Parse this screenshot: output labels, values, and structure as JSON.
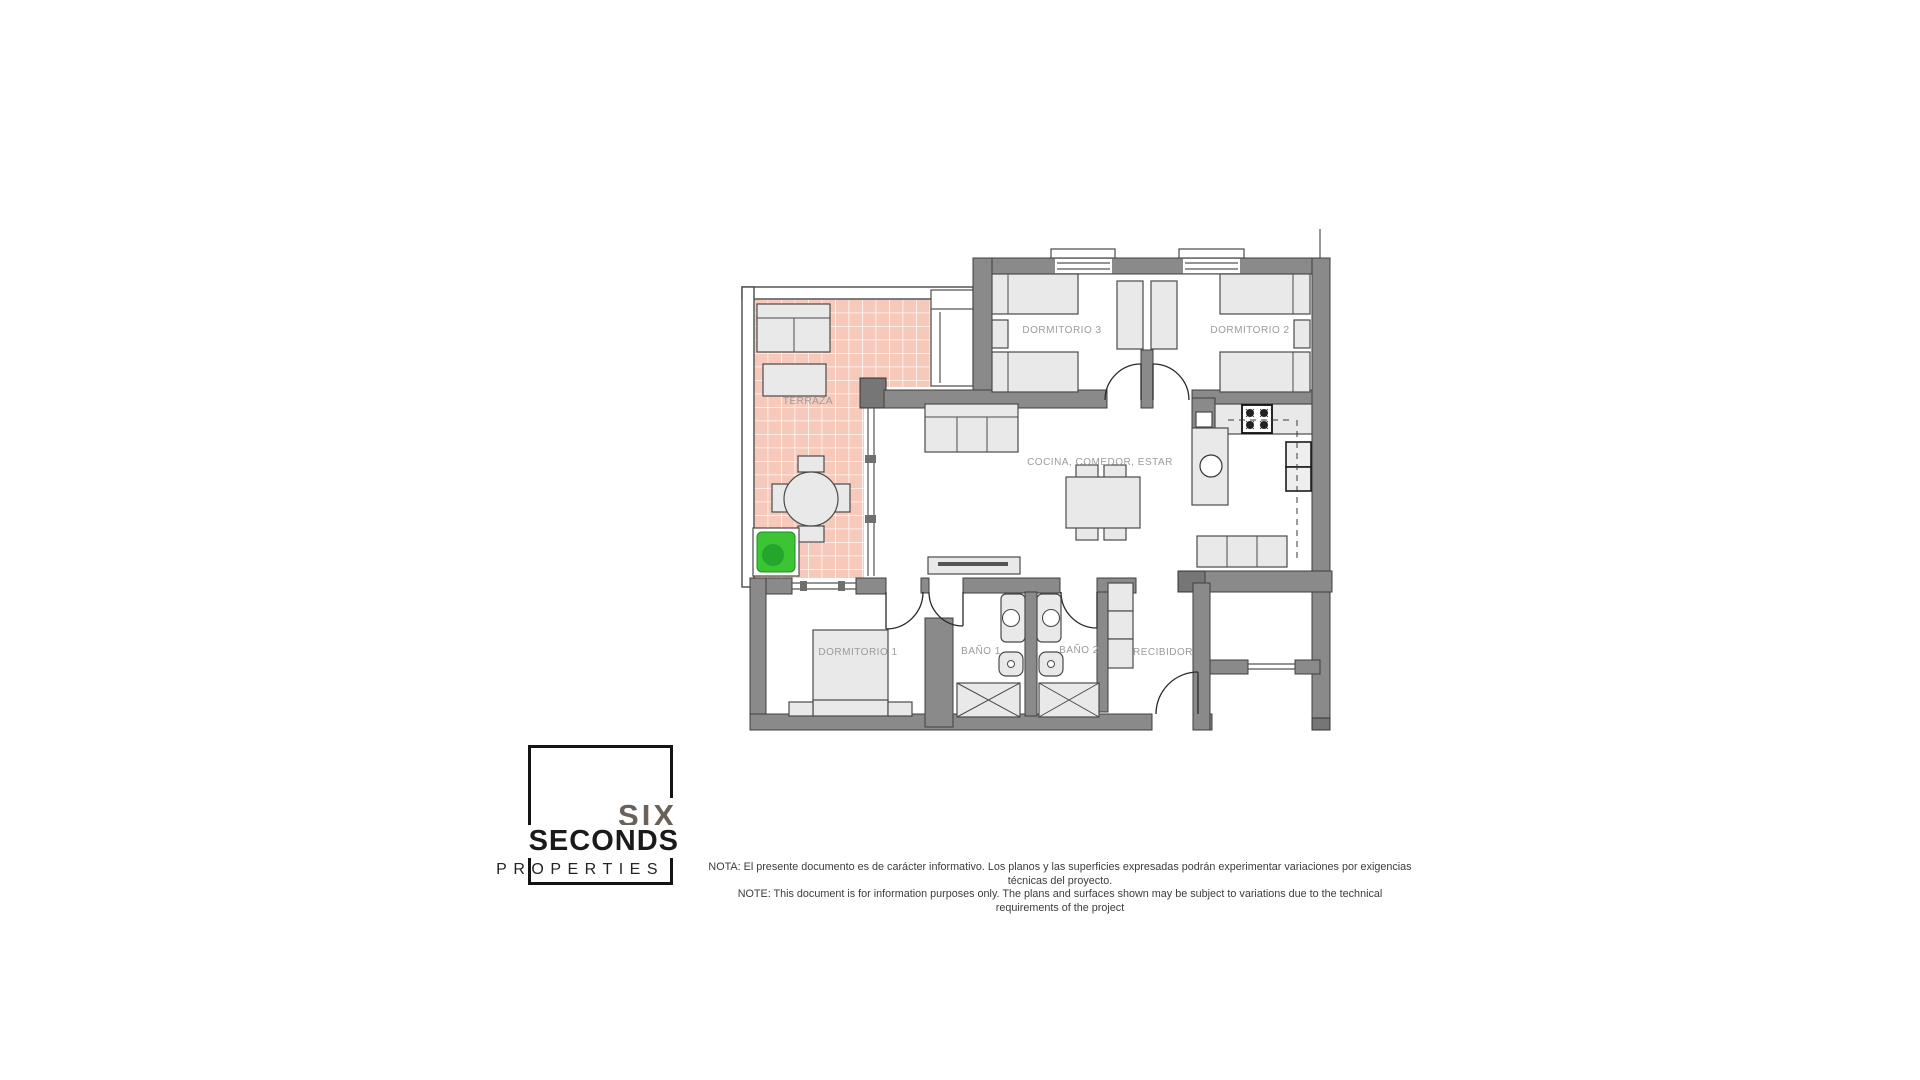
{
  "colors": {
    "background": "#ffffff",
    "wall-gray": "#8a8a8a",
    "wall-outline": "#3f3f3f",
    "furniture-fill": "#e9e9e9",
    "furniture-stroke": "#4a4a4a",
    "terrace-tile": "#f6c9bb",
    "tile-grout": "#ffffff",
    "plant-green": "#3cc435",
    "plant-green-dark": "#1e9e2a",
    "label-gray": "#9b9b9b",
    "logo-six-color": "#6a6158",
    "logo-black": "#1a1a1a",
    "text-dark": "#3c3c3c"
  },
  "plan": {
    "rooms": [
      {
        "id": "terraza",
        "label": "TERRAZA"
      },
      {
        "id": "dormitorio-3",
        "label": "DORMITORIO 3"
      },
      {
        "id": "dormitorio-2",
        "label": "DORMITORIO 2"
      },
      {
        "id": "cocina-comedor-estar",
        "label": "COCINA, COMEDOR, ESTAR"
      },
      {
        "id": "dormitorio-1",
        "label": "DORMITORIO 1"
      },
      {
        "id": "bano-1",
        "label": "BAÑO 1"
      },
      {
        "id": "bano-2",
        "label": "BAÑO 2"
      },
      {
        "id": "recibidor",
        "label": "RECIBIDOR"
      }
    ]
  },
  "logo": {
    "line1": "SIX",
    "line2": "SECONDS",
    "line3": "PROPERTIES"
  },
  "disclaimer": {
    "line_es": "NOTA: El presente documento es de carácter informativo. Los planos y las superficies expresadas podrán experimentar variaciones por exigencias técnicas del proyecto.",
    "line_en": "NOTE: This document is for information purposes only. The plans and surfaces shown may be subject to variations due to the technical requirements of the project"
  }
}
